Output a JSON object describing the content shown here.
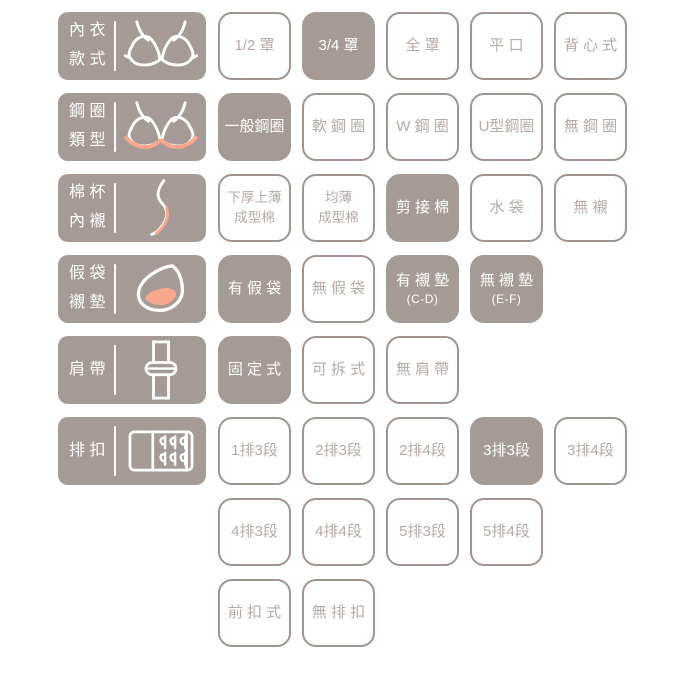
{
  "colors": {
    "mauve": "#a59a96",
    "accent_pink": "#f9a78e",
    "button_border": "#a3938f",
    "unselected_text": "#b7a9a5",
    "selected_text": "#ffffff",
    "background": "#ffffff"
  },
  "rows": [
    {
      "category": {
        "name": "bra-style",
        "lines": [
          "內 衣",
          "款 式"
        ],
        "icon": "bra-icon"
      },
      "options": [
        {
          "label": "1/2 罩",
          "selected": false
        },
        {
          "label": "3/4 罩",
          "selected": true
        },
        {
          "label": "全 罩",
          "selected": false
        },
        {
          "label": "平 口",
          "selected": false
        },
        {
          "label": "背 心 式",
          "selected": false
        }
      ]
    },
    {
      "category": {
        "name": "wire-type",
        "lines": [
          "鋼 圈",
          "類 型"
        ],
        "icon": "underwire-icon"
      },
      "options": [
        {
          "label": "一般鋼圈",
          "selected": true
        },
        {
          "label": "軟 鋼 圈",
          "selected": false
        },
        {
          "label": "W 鋼 圈",
          "selected": false
        },
        {
          "label": "U型鋼圈",
          "selected": false
        },
        {
          "label": "無 鋼 圈",
          "selected": false
        }
      ]
    },
    {
      "category": {
        "name": "cup-lining",
        "lines": [
          "棉 杯",
          "內 襯"
        ],
        "icon": "cup-profile-icon"
      },
      "options": [
        {
          "lines": [
            "下厚上薄",
            "成型棉"
          ],
          "selected": false
        },
        {
          "lines": [
            "均薄",
            "成型棉"
          ],
          "selected": false
        },
        {
          "label": "剪 接 棉",
          "selected": true
        },
        {
          "label": "水 袋",
          "selected": false
        },
        {
          "label": "無 襯",
          "selected": false
        }
      ]
    },
    {
      "category": {
        "name": "pad-insert",
        "lines": [
          "假 袋",
          "襯 墊"
        ],
        "icon": "pad-icon"
      },
      "options": [
        {
          "label": "有 假 袋",
          "selected": true
        },
        {
          "label": "無 假 袋",
          "selected": false
        },
        {
          "label": "有 襯 墊",
          "sub": "(C-D)",
          "selected": true
        },
        {
          "label": "無 襯 墊",
          "sub": "(E-F)",
          "selected": true
        }
      ]
    },
    {
      "category": {
        "name": "shoulder-strap",
        "lines": [
          "肩 帶"
        ],
        "icon": "strap-icon"
      },
      "options": [
        {
          "label": "固 定 式",
          "selected": true
        },
        {
          "label": "可 拆 式",
          "selected": false
        },
        {
          "label": "無 肩 帶",
          "selected": false
        }
      ]
    },
    {
      "category": {
        "name": "hook-rows",
        "lines": [
          "排 扣"
        ],
        "icon": "hook-icon"
      },
      "options": [
        {
          "label": "1排3段",
          "selected": false
        },
        {
          "label": "2排3段",
          "selected": false
        },
        {
          "label": "2排4段",
          "selected": false
        },
        {
          "label": "3排3段",
          "selected": true
        },
        {
          "label": "3排4段",
          "selected": false
        }
      ]
    },
    {
      "category": null,
      "options": [
        {
          "label": "4排3段",
          "selected": false
        },
        {
          "label": "4排4段",
          "selected": false
        },
        {
          "label": "5排3段",
          "selected": false
        },
        {
          "label": "5排4段",
          "selected": false
        }
      ]
    },
    {
      "category": null,
      "options": [
        {
          "label": "前 扣 式",
          "selected": false
        },
        {
          "label": "無 排 扣",
          "selected": false
        }
      ]
    }
  ]
}
